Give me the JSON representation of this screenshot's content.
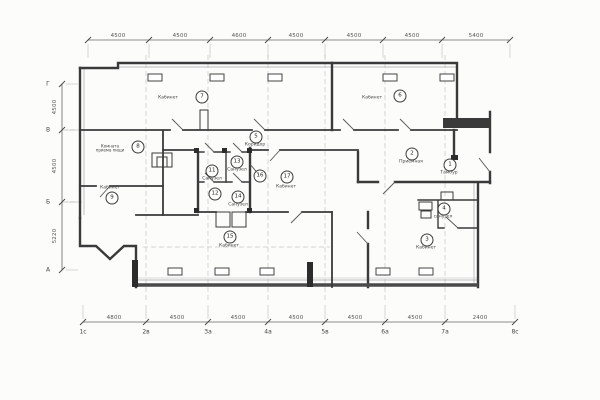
{
  "drawing": {
    "kind": "architectural floor plan",
    "line_color": "#3a3a3a",
    "paper_color": "#fcfcfa"
  },
  "rooms": [
    {
      "number": "1",
      "label": "Тамбур"
    },
    {
      "number": "2",
      "label": "Приемная"
    },
    {
      "number": "3",
      "label": "Кабинет"
    },
    {
      "number": "4",
      "label": "санузел"
    },
    {
      "number": "5",
      "label": "Коридор"
    },
    {
      "number": "6",
      "label": "Кабинет"
    },
    {
      "number": "7",
      "label": "Кабинет"
    },
    {
      "number": "8",
      "label": "Комната приема пищи"
    },
    {
      "number": "9",
      "label": "Кабинет"
    },
    {
      "number": "11",
      "label": "Санузел"
    },
    {
      "number": "12",
      "label": ""
    },
    {
      "number": "13",
      "label": "Санузел"
    },
    {
      "number": "14",
      "label": "Санузел"
    },
    {
      "number": "15",
      "label": "Кабинет"
    },
    {
      "number": "16",
      "label": ""
    },
    {
      "number": "17",
      "label": "Кабинет"
    }
  ],
  "dimensions": {
    "top": [
      "4500",
      "4500",
      "4600",
      "4500",
      "4500",
      "4500",
      "5400"
    ],
    "bottom": [
      "4800",
      "4500",
      "4500",
      "4500",
      "4500",
      "4500",
      "2400"
    ],
    "left": [
      "4500",
      "4500",
      "5220"
    ]
  },
  "axes": {
    "bottom": [
      "1с",
      "2в",
      "3а",
      "4а",
      "5в",
      "6а",
      "7а",
      "8с"
    ],
    "left": [
      "Г",
      "В",
      "Б",
      "А"
    ]
  }
}
